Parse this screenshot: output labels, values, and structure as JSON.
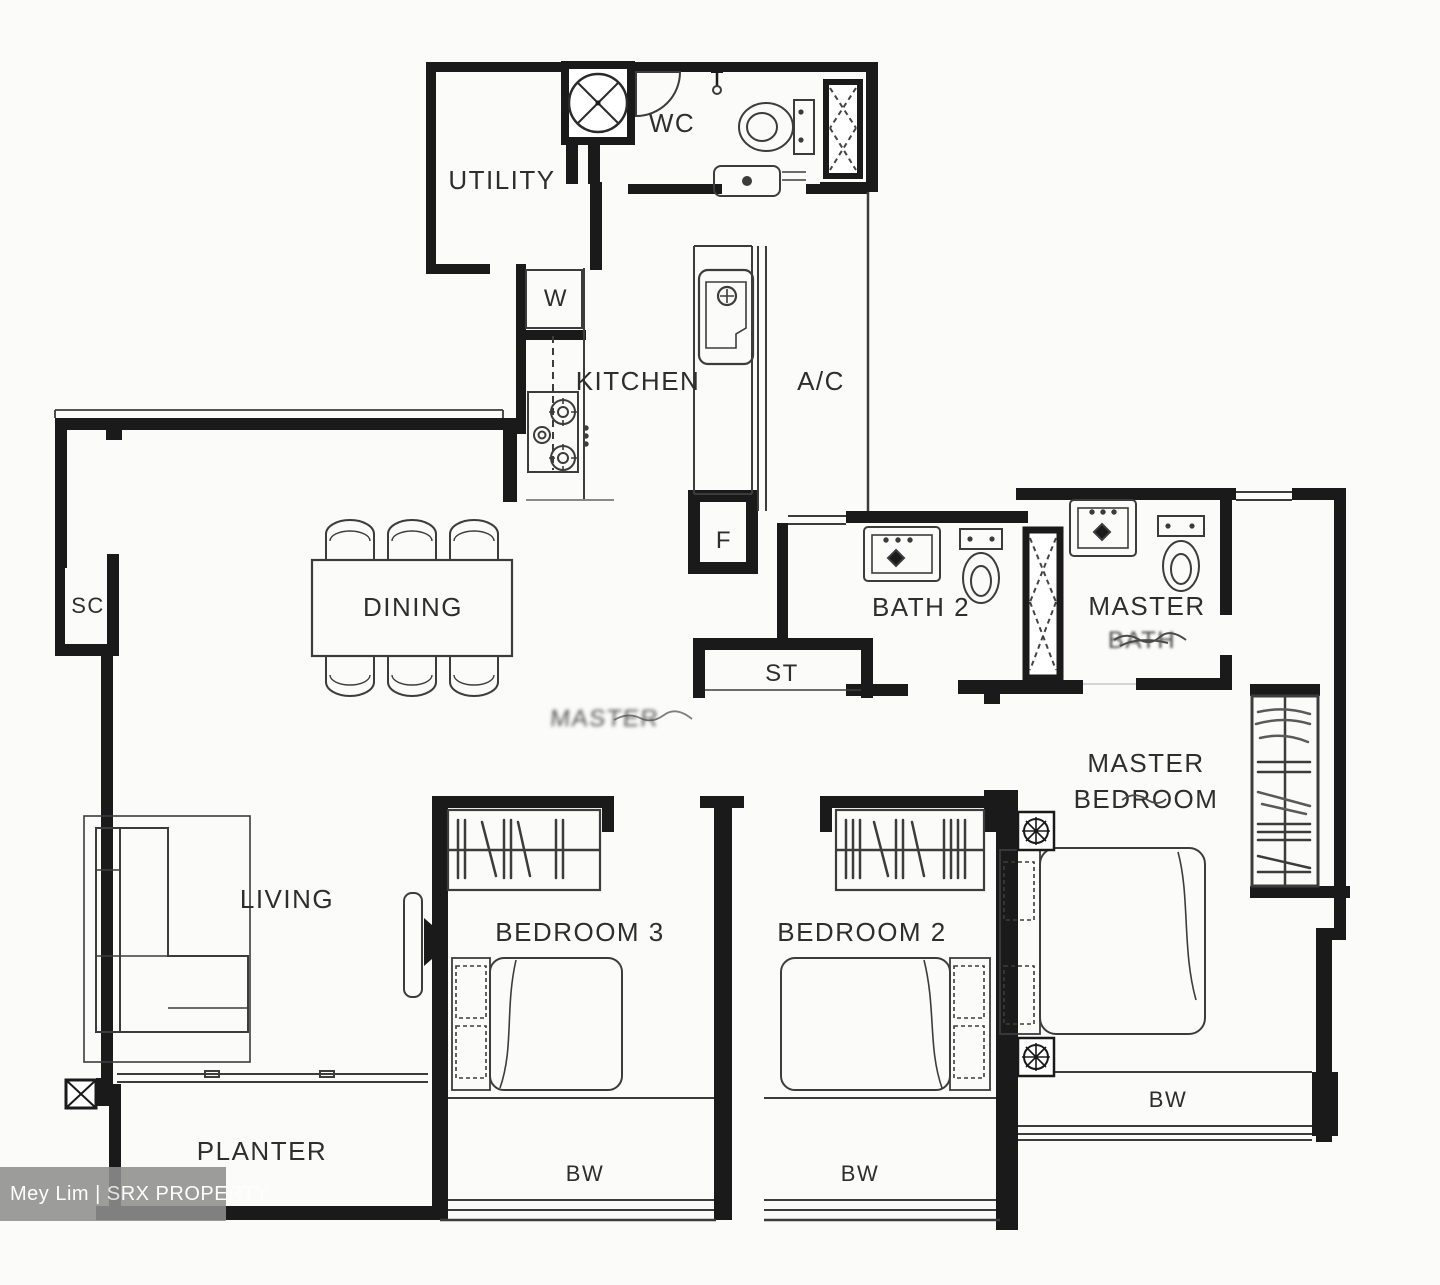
{
  "rooms": {
    "utility": {
      "label": "UTILITY"
    },
    "wc": {
      "label": "WC"
    },
    "washer": {
      "label": "W"
    },
    "kitchen": {
      "label": "KITCHEN"
    },
    "aircon": {
      "label": "A/C"
    },
    "fridge": {
      "label": "F"
    },
    "dining": {
      "label": "DINING"
    },
    "shoe_cabinet": {
      "label": "SC"
    },
    "bath2": {
      "label": "BATH 2"
    },
    "master_bath": {
      "line1": "MASTER",
      "line2": "BATH"
    },
    "store": {
      "label": "ST"
    },
    "hall_smudge": {
      "label": "MASTER"
    },
    "master_bedroom": {
      "line1": "MASTER",
      "line2": "BEDROOM"
    },
    "bedroom3": {
      "label": "BEDROOM 3"
    },
    "bedroom2": {
      "label": "BEDROOM 2"
    },
    "living": {
      "label": "LIVING"
    },
    "planter": {
      "label": "PLANTER"
    },
    "bay_window_bedroom3": {
      "label": "BW"
    },
    "bay_window_bedroom2": {
      "label": "BW"
    },
    "bay_window_master": {
      "label": "BW"
    }
  },
  "watermark": {
    "text": "Mey Lim | SRX PROPERTY",
    "background": "#8f8f8f",
    "color": "#ffffff"
  },
  "colors": {
    "wall": "#1a1a1a",
    "fixture_line": "#3c3c3c",
    "paper": "#fbfbf9"
  }
}
